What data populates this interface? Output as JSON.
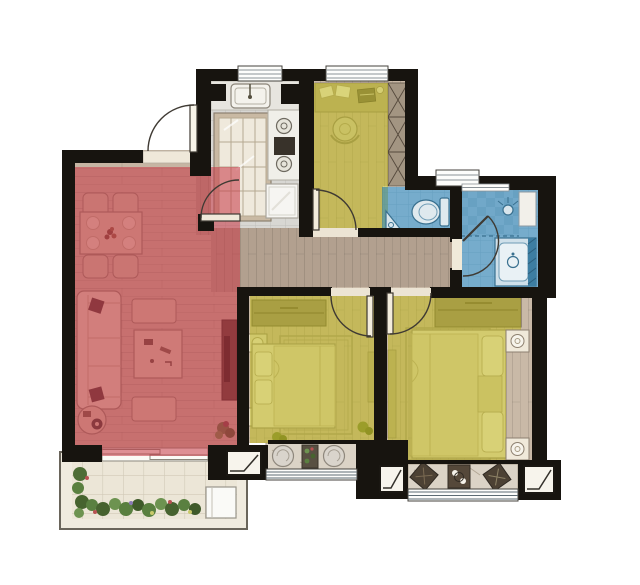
{
  "image": {
    "kind": "apartment-floor-plan",
    "width_px": 640,
    "height_px": 585,
    "visible_text": "none"
  },
  "palette": {
    "wall": "#17140f",
    "floor_wood_living": "#c6b5a3",
    "floor_wood_corridor": "#b2a08f",
    "floor_wood_bedroom": "#c9b9a7",
    "floor_tile_kitchen": "#d8d7d3",
    "floor_tile_bath": "#e9edee",
    "balcony_deck": "#f0ebdf",
    "stone_sill": "#dbd3c6",
    "overlay_red": "#c73a48",
    "overlay_yellow": "#c0b81e",
    "overlay_blue": "#1776b0",
    "furniture_light": "#e0d4bf",
    "furniture_cream": "#ece3d0",
    "furniture_dark": "#8e8271",
    "wood_accent": "#b9aa8f",
    "fixture_blue": "#d8e5ec",
    "fixture_stroke": "#39708f",
    "window_line": "#5d6b73",
    "door_stroke": "#3f3a33",
    "plant_green": "#5a8040",
    "white": "#fdfdfb"
  },
  "rooms": [
    {
      "id": "living-dining-room",
      "overlay": "overlay_red"
    },
    {
      "id": "kitchen",
      "overlay": "none"
    },
    {
      "id": "study-bedroom",
      "overlay": "overlay_yellow"
    },
    {
      "id": "toilet-wc",
      "overlay": "overlay_blue"
    },
    {
      "id": "bathroom-shower",
      "overlay": "overlay_blue"
    },
    {
      "id": "hallway",
      "overlay": "none"
    },
    {
      "id": "bedroom-2",
      "overlay": "overlay_yellow"
    },
    {
      "id": "master-bedroom",
      "overlay": "overlay_yellow"
    },
    {
      "id": "garden-balcony",
      "overlay": "none"
    },
    {
      "id": "bay-window-seat-bedroom-2",
      "overlay": "none"
    },
    {
      "id": "bay-window-seat-master",
      "overlay": "none"
    }
  ],
  "fixtures": [
    "entry-door",
    "kitchen-sink",
    "gas-stove",
    "fridge",
    "glazed-partition",
    "desk",
    "desk-chair",
    "wardrobes",
    "toilet-bowl",
    "corner-basin",
    "shower-head",
    "vanity-sink",
    "dining-table",
    "dining-chairs",
    "sofa",
    "coffee-table",
    "tv-cabinet",
    "beds",
    "nightstands",
    "washer",
    "plants",
    "bay-stools",
    "bay-armchairs"
  ]
}
